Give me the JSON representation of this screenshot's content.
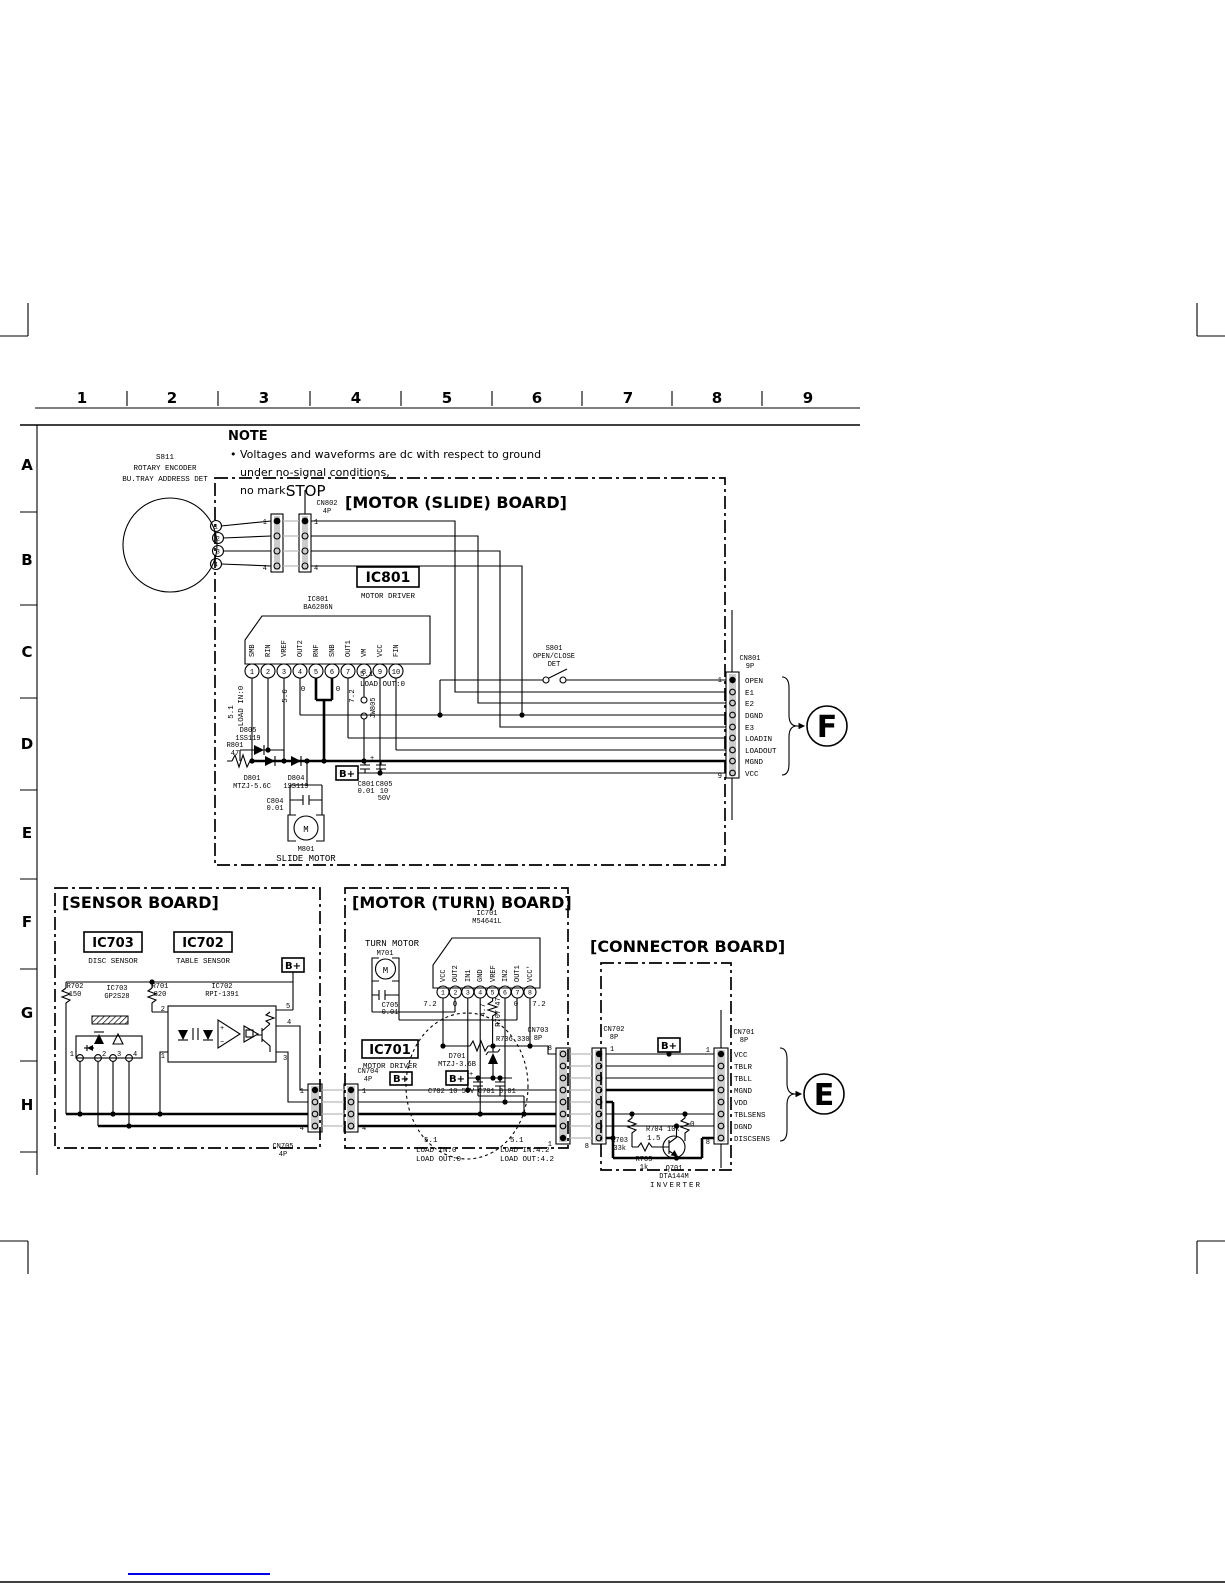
{
  "colors": {
    "line": "#000000",
    "link_blue": "#0000ee",
    "connector_band": "#cccccc"
  },
  "grid": {
    "cols": [
      "1",
      "2",
      "3",
      "4",
      "5",
      "6",
      "7",
      "8",
      "9"
    ],
    "rows": [
      "A",
      "B",
      "C",
      "D",
      "E",
      "F",
      "G",
      "H"
    ]
  },
  "note": {
    "title": "NOTE",
    "l1": "• Voltages and waveforms are dc with respect to ground",
    "l2": "under no-signal conditions,",
    "l3": "no mark:",
    "stop": "STOP"
  },
  "encoder": {
    "ref": "S811",
    "name1": "ROTARY ENCODER",
    "name2": "BU.TRAY ADDRESS DET",
    "pins": [
      "1",
      "2",
      "3",
      "4"
    ]
  },
  "cn802": {
    "ref": "CN802",
    "size": "4P",
    "p1": "1",
    "p4": "4"
  },
  "slide": {
    "title": "[MOTOR (SLIDE) BOARD]",
    "ic_box": "IC801",
    "ic_role": "MOTOR DRIVER",
    "ic_ref": "IC801",
    "ic_part": "BA6286N",
    "pins": [
      {
        "n": "1",
        "name": "SMB"
      },
      {
        "n": "2",
        "name": "RIN"
      },
      {
        "n": "3",
        "name": "VREF"
      },
      {
        "n": "4",
        "name": "OUT2"
      },
      {
        "n": "5",
        "name": "RNF"
      },
      {
        "n": "6",
        "name": "SNB"
      },
      {
        "n": "7",
        "name": "OUT1"
      },
      {
        "n": "8",
        "name": "VM"
      },
      {
        "n": "9",
        "name": "VCC"
      },
      {
        "n": "10",
        "name": "FIN"
      }
    ],
    "v_in1": "5.1",
    "v_in2": "LOAD IN:0",
    "v3": "5.6",
    "v4": "0",
    "v6": "0",
    "v9": "7.2",
    "v_out1": "5.1",
    "v_out2": "LOAD OUT:0",
    "jw": "JW805",
    "d805": "D805",
    "d805v": "1SS119",
    "r801": "R801",
    "r801v": "47",
    "d801": "D801",
    "d801v": "MTZJ-5.6C",
    "d804": "D804",
    "d804v": "1SS119",
    "bplus": "B+",
    "c801": "C801",
    "c801v": "0.01",
    "c805": "C805",
    "c805v1": "10",
    "c805v2": "50V",
    "c805_plus": "+",
    "c804": "C804",
    "c804v": "0.01",
    "motor_m": "M",
    "motor_ref": "M801",
    "motor_name": "SLIDE MOTOR",
    "s801": "S801",
    "s801a": "OPEN/CLOSE",
    "s801b": "DET"
  },
  "cn801": {
    "ref": "CN801",
    "size": "9P",
    "p1": "1",
    "p9": "9",
    "signals": [
      "OPEN",
      "E1",
      "E2",
      "DGND",
      "E3",
      "LOADIN",
      "LOADOUT",
      "MGND",
      "VCC"
    ],
    "callout": "F"
  },
  "sensor": {
    "title": "[SENSOR BOARD]",
    "ic703_box": "IC703",
    "ic703_role": "DISC SENSOR",
    "ic702_box": "IC702",
    "ic702_role": "TABLE SENSOR",
    "bplus": "B+",
    "r702": "R702",
    "r702v": "150",
    "ic703_ref": "IC703",
    "ic703_part": "GP2S28",
    "r701": "R701",
    "r701v": "820",
    "ic702_ref": "IC702",
    "ic702_part": "RPI-1391",
    "ip": [
      "1",
      "2",
      "3",
      "4"
    ],
    "op2": "2",
    "op1": "1",
    "op5": "5",
    "op4": "4",
    "op3": "3"
  },
  "cn705": {
    "ref": "CN705",
    "size": "4P",
    "p1": "1",
    "p4": "4"
  },
  "cn704": {
    "ref": "CN704",
    "size": "4P",
    "p1": "1",
    "p4": "4"
  },
  "turn": {
    "title": "[MOTOR (TURN) BOARD]",
    "ic_ref": "IC701",
    "ic_part": "M54641L",
    "motor_name": "TURN MOTOR",
    "motor_ref": "M701",
    "motor_m": "M",
    "c705": "C705",
    "c705v": "0.01",
    "pins": [
      {
        "n": "1",
        "name": "VCC"
      },
      {
        "n": "2",
        "name": "OUT2"
      },
      {
        "n": "3",
        "name": "IN1"
      },
      {
        "n": "4",
        "name": "GND"
      },
      {
        "n": "5",
        "name": "VREF"
      },
      {
        "n": "6",
        "name": "IN2"
      },
      {
        "n": "7",
        "name": "OUT1"
      },
      {
        "n": "8",
        "name": "VCC'"
      }
    ],
    "v1": "7.2",
    "v2": "0",
    "v5": "4.7",
    "r707": "R707 47",
    "v7": "0",
    "v8": "7.2",
    "ic_box": "IC701",
    "ic_role": "MOTOR DRIVER",
    "bplus1": "B+",
    "bplus2": "B+",
    "d701": "D701",
    "d701v": "MTZJ-3.6B",
    "r706": "R706 330",
    "c702": "C702 10 50V",
    "c702_plus": "+",
    "c701": "C701 0.01",
    "load1a": "5.1",
    "load1b": "LOAD IN:0",
    "load1c": "LOAD OUT:0",
    "load2a": "5.1",
    "load2b": "LOAD IN:4.2",
    "load2c": "LOAD OUT:4.2"
  },
  "cn703": {
    "ref": "CN703",
    "size": "8P",
    "p8": "8",
    "p1": "1"
  },
  "conn": {
    "title": "[CONNECTOR BOARD]",
    "bplus": "B+",
    "r703": "R703",
    "r703v": "33k",
    "r705": "R705",
    "r705v": "1k",
    "r704": "R704 10k",
    "vb": "1.5",
    "vt": "0",
    "q701": "Q701",
    "q701p": "DTA144M",
    "q701r": "INVERTER"
  },
  "cn702": {
    "ref": "CN702",
    "size": "8P",
    "p1": "1",
    "p8": "8"
  },
  "cn701": {
    "ref": "CN701",
    "size": "8P",
    "p1": "1",
    "p8": "8",
    "signals": [
      "VCC",
      "TBLR",
      "TBLL",
      "MGND",
      "VDD",
      "TBLSENS",
      "DGND",
      "DISCSENS"
    ],
    "callout": "E"
  }
}
